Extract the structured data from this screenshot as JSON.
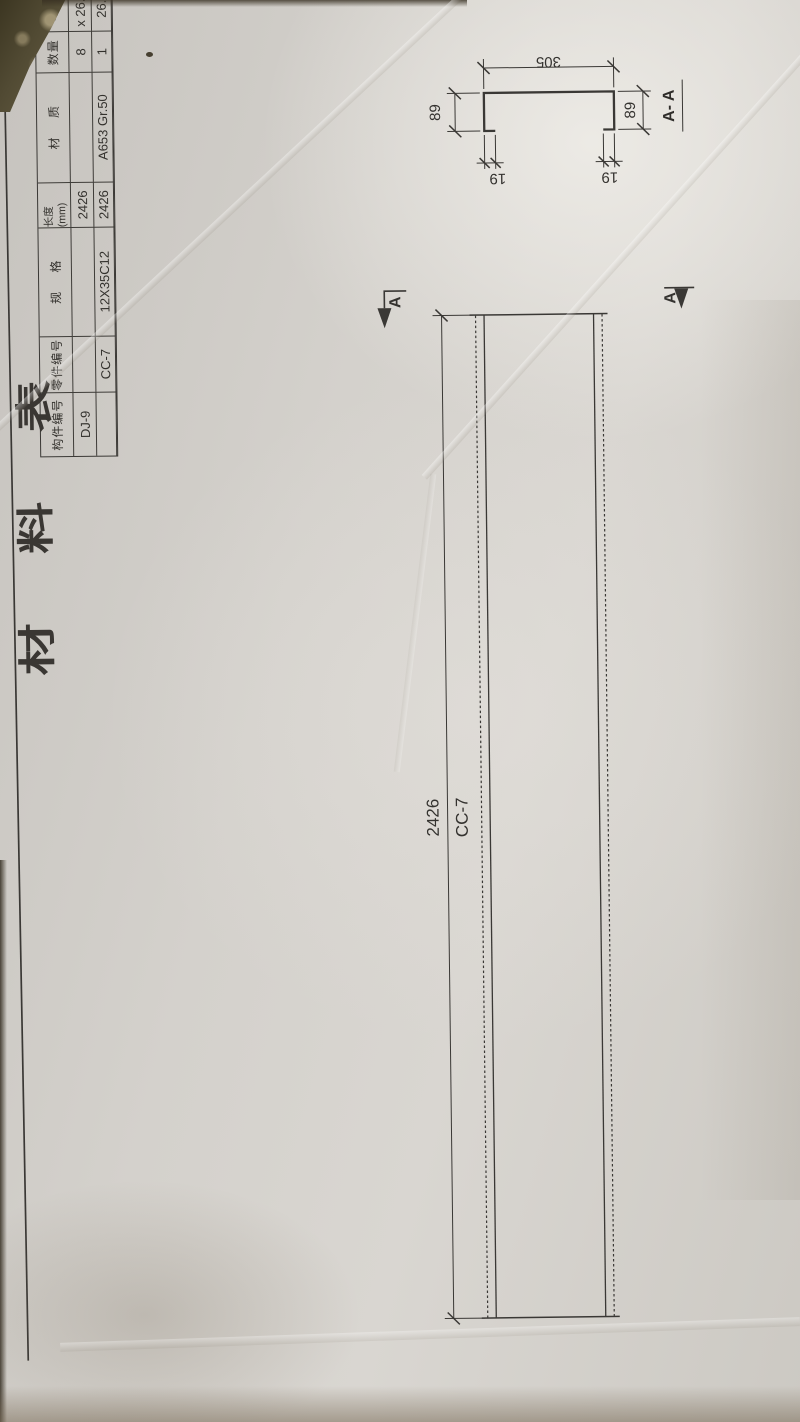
{
  "colors": {
    "paper": "#d5d2cd",
    "ink": "#3a3835",
    "background_dirt": "#574e3a"
  },
  "material_table": {
    "title": "材料表",
    "headers": [
      "构件编号",
      "零件编号",
      "规 格",
      "长度(mm)",
      "材 质",
      "数量",
      "单 重"
    ],
    "rows": [
      [
        "DJ-9",
        "",
        "",
        "2426",
        "",
        "8",
        "x 26.69"
      ],
      [
        "",
        "CC-7",
        "12X35C12",
        "2426",
        "A653 Gr.50",
        "1",
        "26.6"
      ]
    ]
  },
  "plan_view": {
    "length_dim": "2426",
    "member_label": "CC-7",
    "section_letter": "A"
  },
  "section_view": {
    "label": "A- A",
    "web_dim": "305",
    "flange_dim_top": "89",
    "flange_dim_bottom": "89",
    "lip_dim_top": "19",
    "lip_dim_bottom": "19"
  }
}
